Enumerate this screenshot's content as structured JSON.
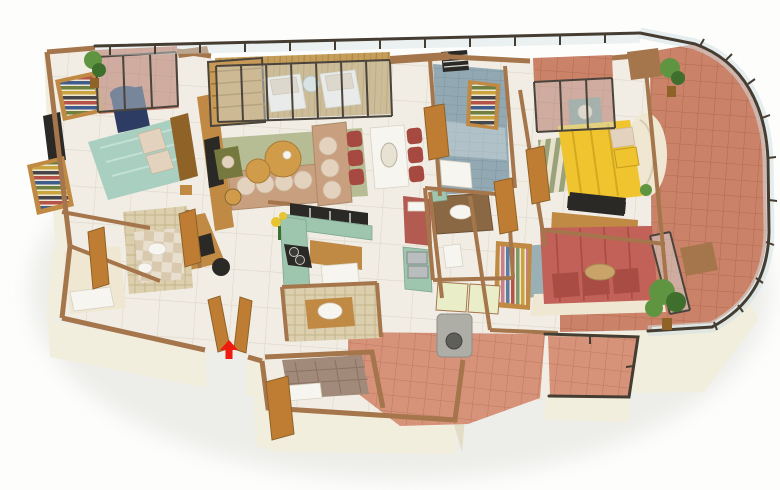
{
  "meta": {
    "description": "Photorealistic 3D isometric floor plan render of a four-room apartment with curved glass-railed balcony, no on-image text, red arrow marking the entrance"
  },
  "palette": {
    "wall_face": "#f2eedd",
    "wall_face_dark": "#e4ddc6",
    "wall_cap": "#a5764c",
    "wood": "#c08a44",
    "wood_dark": "#8f6228",
    "door": "#bf7d33",
    "floor_marble": "#f1ede5",
    "floor_line": "#ded6c8",
    "terracotta": "#ca8268",
    "terracotta_grout": "#b26a52",
    "terracotta_light": "#d7937a",
    "deck_wood": "#c69e5b",
    "teal_bed": "#a9cfc1",
    "navy_chair": "#2c3c62",
    "tan_sofa": "#c9a07f",
    "cushion": "#e3d2bd",
    "rug_green": "#b6bd94",
    "table_wood": "#d09c4a",
    "olive_chair": "#76793f",
    "dining_red": "#a64940",
    "yellow_bed": "#efc42e",
    "gray_chair": "#7f8a80",
    "red_bed": "#c26158",
    "red_pillow": "#a84c44",
    "kitchen_green": "#9ec5ae",
    "fridge_red": "#b35b51",
    "blue_tile": "#92a8b2",
    "washer": "#aeaea7",
    "railing": "#463d32",
    "glass": "#d4e0e2",
    "glass_frame": "#4a443c",
    "arrow_red": "#ed1c0f",
    "plant": "#5f9440",
    "plant_dark": "#3f6f2c",
    "cream": "#efe7d2",
    "daybed": "#a18a79",
    "mosaic_wall": "#dbcfae",
    "checker_a": "#e9dfcf",
    "checker_b": "#d9c9ae"
  },
  "rooms": {
    "master_bedroom": "Master Bedroom",
    "master_balcony": "Master Bedroom Balcony",
    "living_room": "Living Room",
    "deck_balcony": "Living Room Deck Balcony",
    "dining": "Dining Area",
    "kitchen": "Kitchen",
    "foyer": "Foyer / Study Nook",
    "bathroom_left": "Bathroom 1",
    "bathroom_mosaic": "Bathroom 2 (Mosaic Shower Cube)",
    "bathroom_blue": "Bathroom 3 (Blue Tiled)",
    "bathroom_vanity": "Bathroom 4 (Vanity)",
    "bathroom_small": "Bathroom 5",
    "bedroom2": "Bedroom 2 (Yellow Bed)",
    "bedroom2_balcony": "Bedroom 2 Balcony",
    "bedroom3": "Bedroom 3 (Red Bed)",
    "walkway_balcony": "Curved Wrap-around Balcony",
    "utility": "Utility Terrace",
    "utility_balcony": "Utility Glass Balcony",
    "servant_room": "Store / Servant Room",
    "entrance": "Main Entrance"
  },
  "furniture": {
    "teal_bed": "Queen bed with teal bedding",
    "navy_armchair": "Navy blue armchair",
    "wardrobes_left": "Open wardrobes with folded clothes",
    "tv_unit": "Two-sided wooden TV divider unit",
    "sofa": "Tan L-shaped sectional sofa",
    "coffee_tables": "Round nesting coffee tables",
    "olive_chair": "Olive accent chair",
    "dining_set": "White dining table with six red chairs",
    "kitchen_counters": "Green marble U-shaped kitchen counter",
    "fridge": "Red refrigerator block",
    "island": "White kitchen island",
    "study_desk": "Wooden study desk with monitor and chair",
    "yellow_bed": "Bed with yellow duvet and round cream headboard",
    "gray_armchair": "Grey armchair",
    "red_bed": "Bed with red duvet and pillow row",
    "hanging_wardrobe": "Open wardrobe with hanging clothes",
    "washing_machine": "Washing machine on utility terrace",
    "daybed": "Tufted brown daybed",
    "lounge_chairs": "Two white deck lounge chairs with glass table",
    "plants": "Potted green plants"
  },
  "icons": {
    "entrance_arrow": "Red arrow marking the main entrance"
  }
}
